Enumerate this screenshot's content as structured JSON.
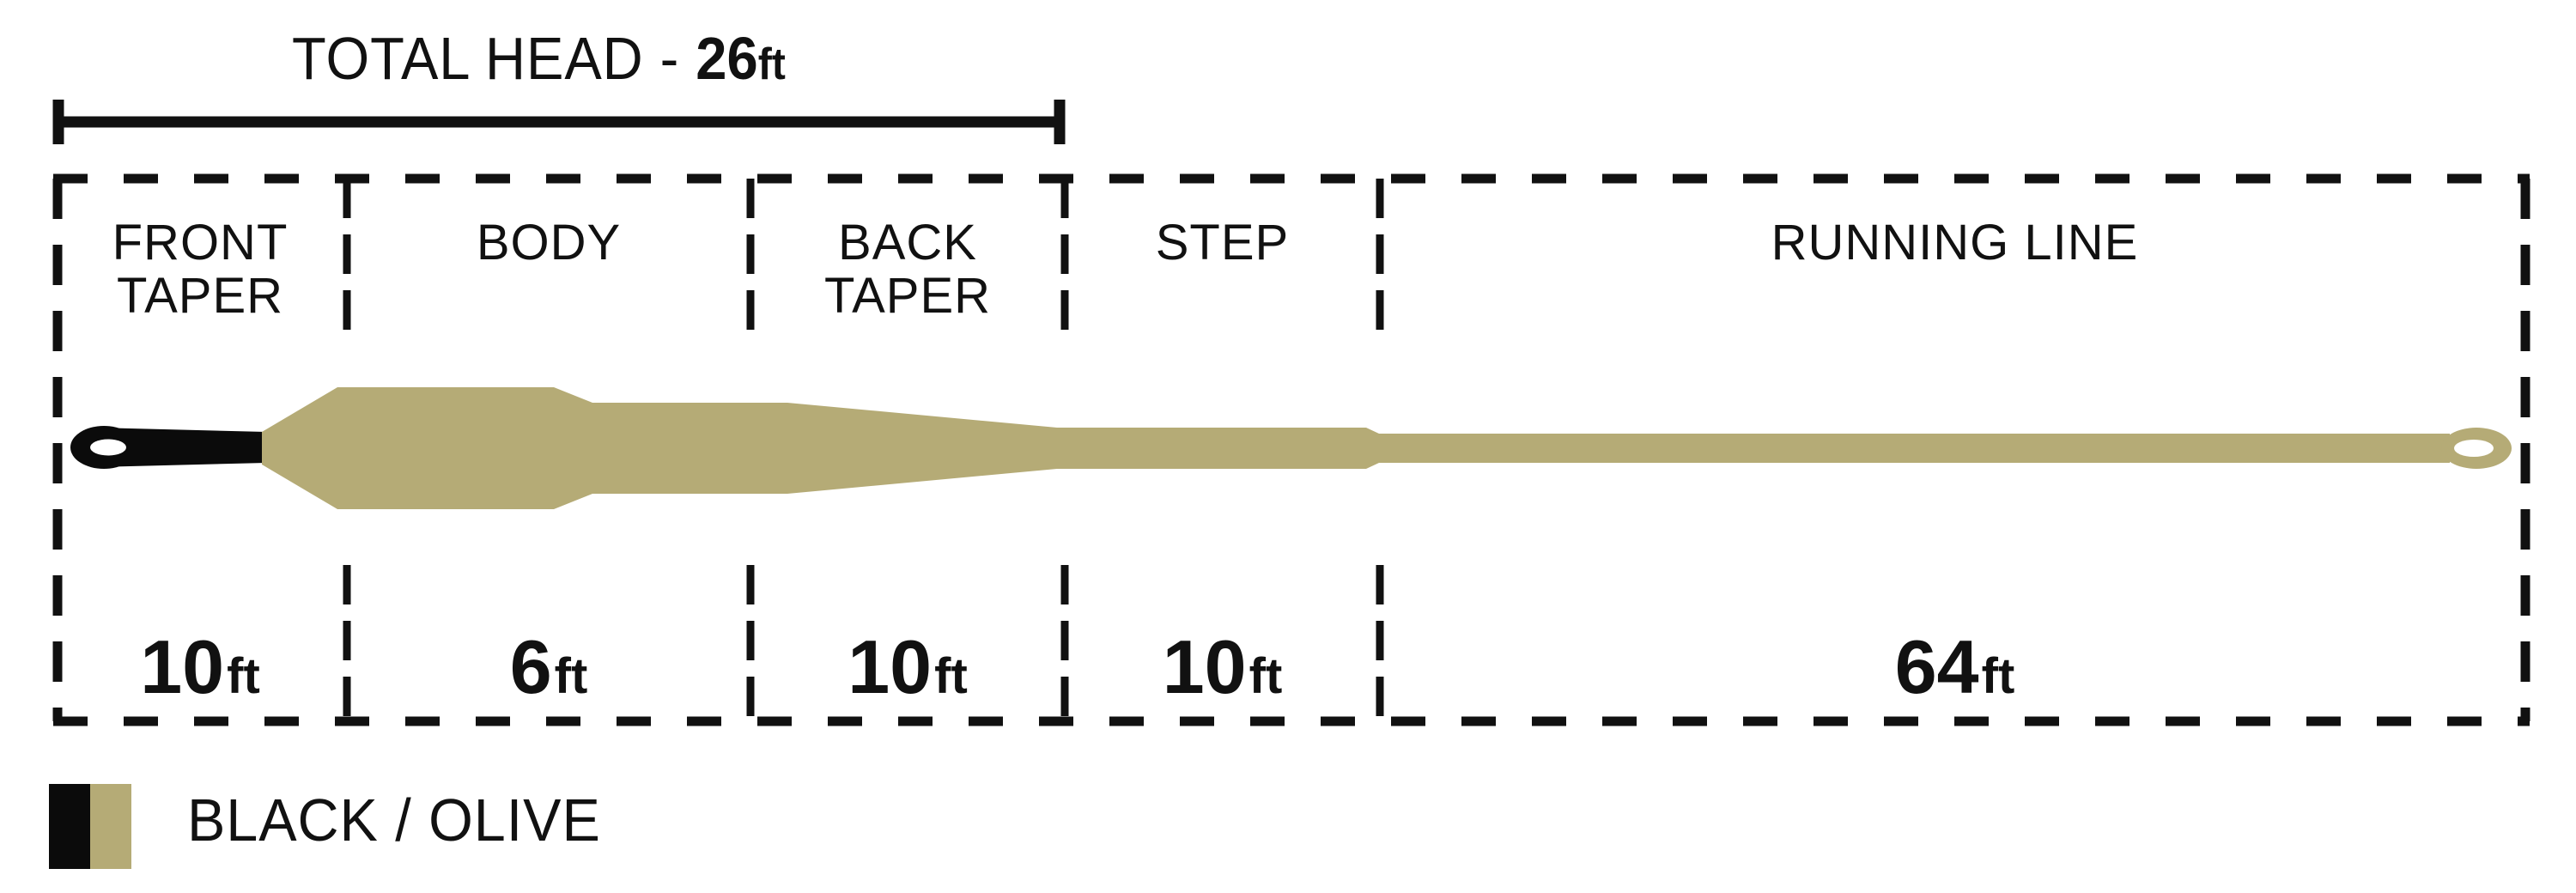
{
  "title": {
    "prefix": "TOTAL HEAD - ",
    "value": "26",
    "unit": "ft"
  },
  "sections": [
    {
      "id": "front-taper",
      "line1": "FRONT",
      "line2": "TAPER",
      "value": "10",
      "unit": "ft"
    },
    {
      "id": "body",
      "line1": "BODY",
      "line2": "",
      "value": "6",
      "unit": "ft"
    },
    {
      "id": "back-taper",
      "line1": "BACK",
      "line2": "TAPER",
      "value": "10",
      "unit": "ft"
    },
    {
      "id": "step",
      "line1": "STEP",
      "line2": "",
      "value": "10",
      "unit": "ft"
    },
    {
      "id": "running-line",
      "line1": "RUNNING LINE",
      "line2": "",
      "value": "64",
      "unit": "ft"
    }
  ],
  "legend": {
    "label": "BLACK / OLIVE"
  },
  "colors": {
    "black": "#0b0b0b",
    "olive": "#b5ab76",
    "ink": "#111111",
    "white": "#ffffff"
  }
}
